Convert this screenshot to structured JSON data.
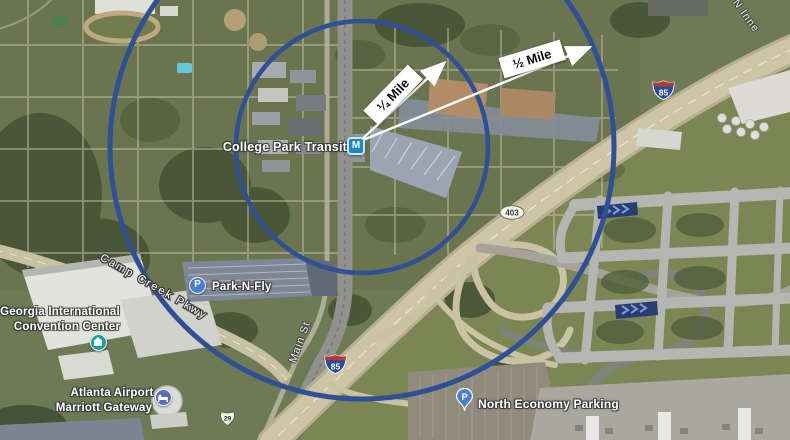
{
  "map": {
    "type": "satellite",
    "station": {
      "label": "College Park Transit",
      "icon_letter": "M"
    },
    "radius_overlay": {
      "quarter_label": "¼ Mile",
      "half_label": "½ Mile"
    },
    "pois": {
      "park_n_fly": {
        "label": "Park-N-Fly",
        "icon_letter": "P"
      },
      "convention_center": {
        "line1": "Georgia International",
        "line2": "Convention Center"
      },
      "marriott": {
        "line1": "Atlanta Airport",
        "line2": "Marriott Gateway"
      },
      "north_economy": {
        "label": "North Economy Parking",
        "icon_letter": "P"
      }
    },
    "roads": {
      "camp_creek": "Camp Creek Pkwy",
      "main_st": "Main St",
      "n_inner": "N Inne"
    },
    "shields": {
      "i85": "85",
      "ga403": "403",
      "us29": "29"
    },
    "colors": {
      "radius_circle": "#2f4f96",
      "arrow": "#ffffff",
      "measure_box_bg": "#ffffff",
      "marta_icon": "#1e88c7",
      "parking_icon": "#4a80c9",
      "convention_icon": "#16a39b",
      "hotel_icon": "#5b6cc0",
      "interstate_blue": "#2a4d9b",
      "interstate_red": "#b33a32"
    }
  }
}
